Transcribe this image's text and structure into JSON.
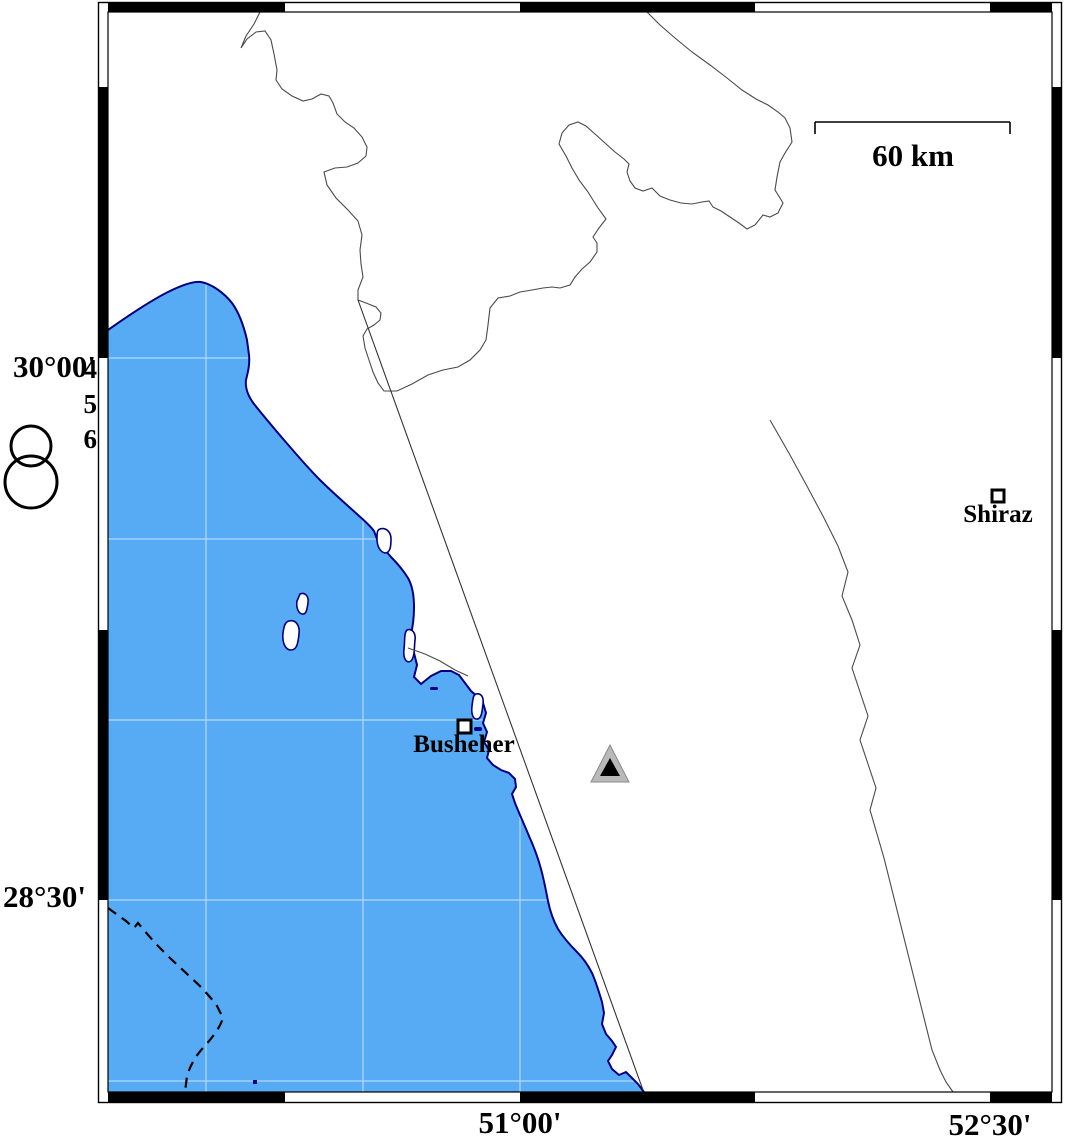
{
  "map_title": "Busheher-Shiraz regional map",
  "axis_labels": {
    "lat_top": "30°00'",
    "lat_bottom": "28°30'",
    "lon_left": "51°00'",
    "lon_right": "52°30'"
  },
  "scale_bar": {
    "label": "60 km"
  },
  "legend": {
    "magnitudes": [
      "4",
      "5",
      "6"
    ]
  },
  "cities": [
    {
      "name": "Busheher"
    },
    {
      "name": "Shiraz"
    }
  ],
  "colors": {
    "sea": "#57abf5",
    "coast": "#000080",
    "land": "#ffffff",
    "border_line": "#4a4a4a",
    "fault_line": "#333333",
    "grid_line": "#ffffff",
    "frame": "#000000",
    "triangle_gray": "#b9b9b9",
    "triangle_black": "#000000"
  }
}
